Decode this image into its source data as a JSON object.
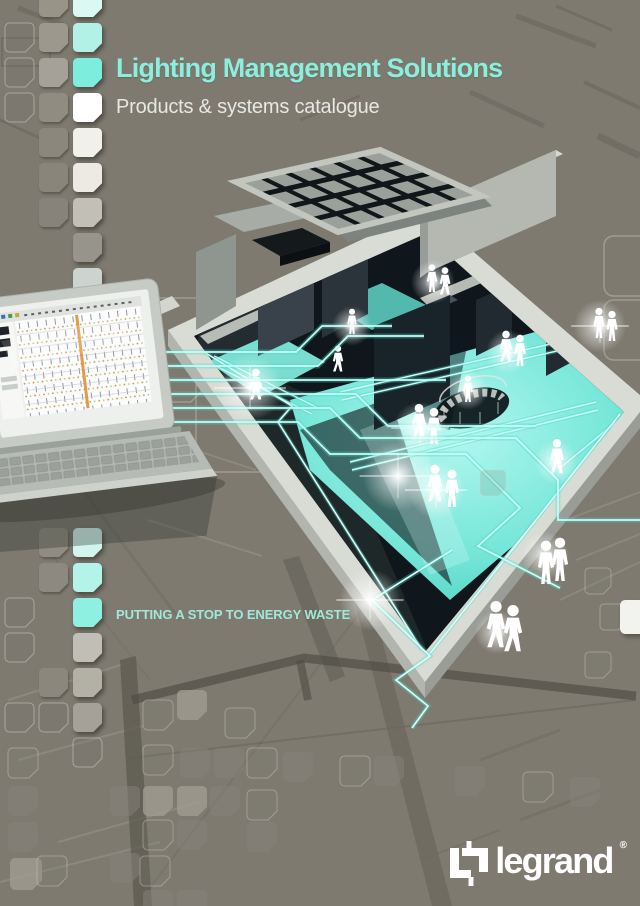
{
  "page": {
    "title": "Lighting Management Solutions",
    "subtitle": "Products & systems catalogue",
    "tagline": "PUTTING A STOP TO ENERGY WASTE"
  },
  "brand": {
    "name": "legrand",
    "registered": "®"
  },
  "colors": {
    "background": "#7e7a70",
    "title": "#8ceedd",
    "subtitle": "#e7e8e2",
    "tagline": "#9fe8da",
    "accent": "#7deedd",
    "logo": "#ffffff"
  },
  "illustration": {
    "scene": "isometric-building-cutaway-with-glowing-lit-floors",
    "laptop": "laptop-running-lighting-management-software",
    "figures": "white-people-silhouettes",
    "connections": "teal-data-connection-lines",
    "background_pattern": "architectural-blueprint-lines-and-chamfered-squares"
  },
  "left_strip": {
    "rows": [
      {
        "y": -12,
        "c2": "#989488",
        "c3": "#dcf8f3"
      },
      {
        "y": 23,
        "c1": "outline",
        "c2": "#9c988e",
        "c3": "#b2f2e6"
      },
      {
        "y": 58,
        "c1": "outline",
        "c2": "#a5a198",
        "c3": "#7deedd"
      },
      {
        "y": 93,
        "c1": "outline",
        "c2": "#908c82",
        "c3": "#ffffff"
      },
      {
        "y": 128,
        "c2": "#8b877d",
        "c3": "#f1f0ea"
      },
      {
        "y": 163,
        "c2": "#89857b",
        "c3": "#eceae3"
      },
      {
        "y": 198,
        "c2": "#87837b",
        "c3": "#c2bfb6"
      },
      {
        "y": 233,
        "c3": "#97948b"
      },
      {
        "y": 268,
        "c3": "#cdd4cf"
      },
      {
        "y": 528,
        "c2": "#908c82",
        "c3": "#d2f5ee"
      },
      {
        "y": 563,
        "c2": "#8d8981",
        "c3": "#b4f3e8"
      },
      {
        "y": 598,
        "c1": "outline",
        "c3": "#8df0e1"
      },
      {
        "y": 633,
        "c1": "outline",
        "c3": "#c1beb5"
      },
      {
        "y": 668,
        "c2": "#8b877d",
        "c3": "#b3b0a6"
      },
      {
        "y": 703,
        "c1": "outline",
        "c2": "outline",
        "c3": "#a5a198"
      },
      {
        "y": 738,
        "c3": "outline"
      }
    ]
  }
}
